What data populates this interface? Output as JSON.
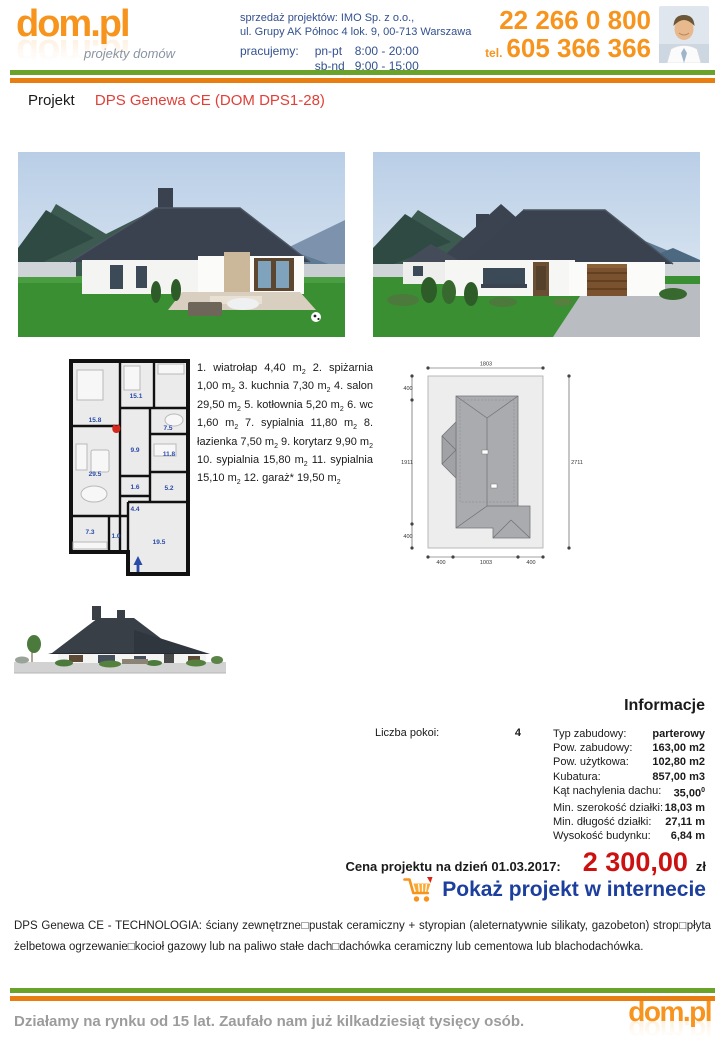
{
  "header": {
    "logo_text": "dom.pl",
    "logo_tagline": "projekty domów",
    "sales_line1": "sprzedaż projektów: IMO Sp. z o.o.,",
    "sales_line2": "ul. Grupy AK Północ 4 lok. 9, 00-713 Warszawa",
    "hours_label": "pracujemy:",
    "hours_weekday_label": "pn-pt",
    "hours_weekday": "8:00 - 20:00",
    "hours_weekend_label": "sb-nd",
    "hours_weekend": "9:00 - 15:00",
    "phone_main": "22 266 0 800",
    "phone_tel_label": "tel.",
    "phone_mobile": "605 366 366"
  },
  "title": {
    "label": "Projekt",
    "name": "DPS Genewa CE (DOM DPS1-28)"
  },
  "rooms": [
    {
      "num": "1.",
      "name": "wiatrołap",
      "area": "4,40 m"
    },
    {
      "num": "2.",
      "name": "spiżarnia",
      "area": "1,00 m"
    },
    {
      "num": "3.",
      "name": "kuchnia",
      "area": "7,30 m"
    },
    {
      "num": "4.",
      "name": "salon",
      "area": "29,50 m"
    },
    {
      "num": "5.",
      "name": "kotłownia",
      "area": "5,20 m"
    },
    {
      "num": "6.",
      "name": "wc",
      "area": "1,60 m"
    },
    {
      "num": "7.",
      "name": "sypialnia",
      "area": "11,80 m"
    },
    {
      "num": "8.",
      "name": "łazienka",
      "area": "7,50 m"
    },
    {
      "num": "9.",
      "name": "korytarz",
      "area": "9,90 m"
    },
    {
      "num": "10.",
      "name": "sypialnia",
      "area": "15,80 m"
    },
    {
      "num": "11.",
      "name": "sypialnia",
      "area": "15,10 m"
    },
    {
      "num": "12.",
      "name": "garaż*",
      "area": "19,50 m"
    }
  ],
  "misc": {
    "unit_sub": "2"
  },
  "floorplan": {
    "labels": [
      "15.8",
      "15.1",
      "7.5",
      "9.9",
      "11.8",
      "29.5",
      "1.6",
      "5.2",
      "4.4",
      "7.3",
      "1.0",
      "19.5"
    ]
  },
  "siteplan": {
    "dim_top": "1803",
    "dim_left_top": "400",
    "dim_left_mid": "1911",
    "dim_left_bottom": "400",
    "dim_right": "2711",
    "dim_bottom_left": "400",
    "dim_bottom_mid": "1003",
    "dim_bottom_right": "400"
  },
  "info": {
    "heading": "Informacje",
    "rooms_label": "Liczba pokoi:",
    "rooms_value": "4",
    "rows": [
      {
        "label": "Typ zabudowy:",
        "value": "parterowy"
      },
      {
        "label": "Pow. zabudowy:",
        "value": "163,00 m2"
      },
      {
        "label": "Pow. użytkowa:",
        "value": "102,80 m2"
      },
      {
        "label": "Kubatura:",
        "value": "857,00 m3"
      },
      {
        "label": "Kąt nachylenia dachu:",
        "value": "35,00",
        "sup": "0"
      },
      {
        "label": "Min. szerokość działki:",
        "value": "18,03 m"
      },
      {
        "label": "Min. długość działki:",
        "value": "27,11 m"
      },
      {
        "label": "Wysokość budynku:",
        "value": "6,84 m"
      }
    ]
  },
  "price": {
    "label": "Cena projektu na dzień 01.03.2017:",
    "amount": "2 300,00",
    "currency": "zł",
    "link": "Pokaż projekt w internecie"
  },
  "description": "DPS Genewa CE - TECHNOLOGIA: ściany zewnętrzne□pustak ceramiczny + styropian (aleternatywnie silikaty, gazobeton) strop□płyta żelbetowa ogrzewanie□kocioł gazowy lub na paliwo stałe dach□dachówka ceramiczny lub cementowa lub blachodachówka.",
  "footer": {
    "text": "Działamy na rynku od 15 lat. Zaufało nam już kilkadziesiąt tysięcy osób.",
    "logo_text": "dom.pl"
  },
  "colors": {
    "brand_orange": "#f7941e",
    "navy_text": "#33518f",
    "title_red": "#e04038",
    "price_red": "#cc1111",
    "link_blue": "#1c3f9e",
    "stripe_green": "#6aa32a",
    "stripe_orange": "#e87d11",
    "plan_blue": "#2a4aa8",
    "footer_gray": "#9c9c9c"
  }
}
